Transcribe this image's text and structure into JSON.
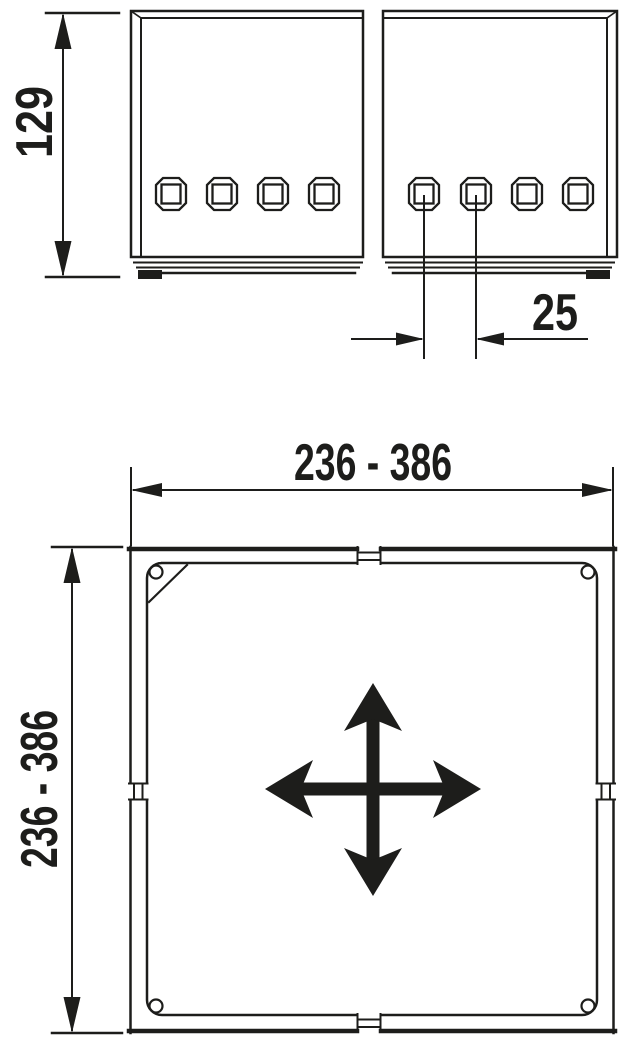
{
  "colors": {
    "line": "#1d1d1b",
    "background": "#ffffff"
  },
  "front_view": {
    "height_dim_label": "129",
    "hole_spacing_dim_label": "25"
  },
  "plan_view": {
    "width_dim_label": "236 - 386",
    "depth_dim_label": "236 - 386"
  }
}
